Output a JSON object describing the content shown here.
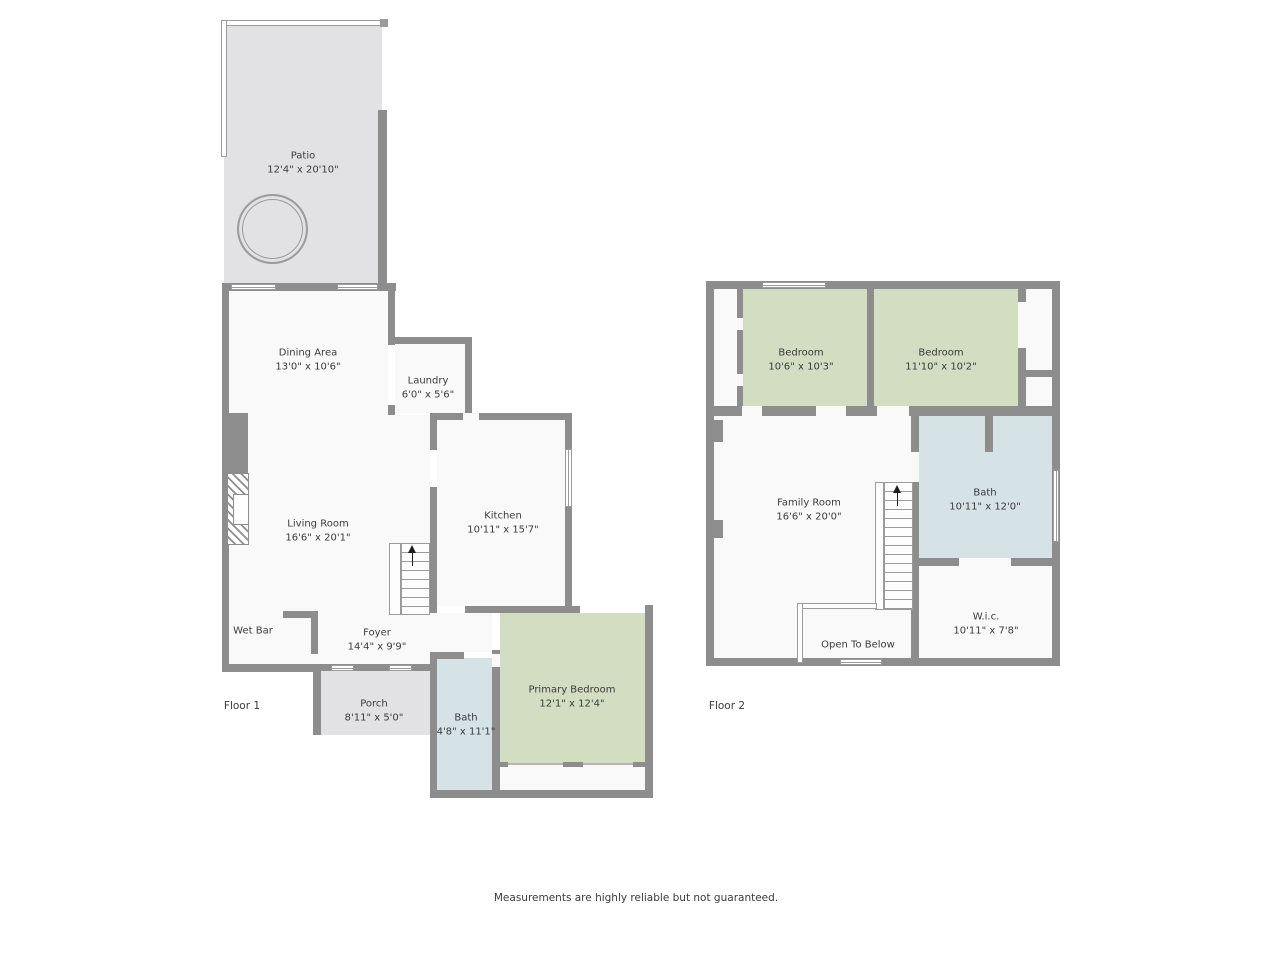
{
  "floor1": {
    "label": "Floor 1",
    "rooms": {
      "patio": {
        "name": "Patio",
        "dims": "12'4\" x 20'10\""
      },
      "dining_area": {
        "name": "Dining Area",
        "dims": "13'0\" x 10'6\""
      },
      "laundry": {
        "name": "Laundry",
        "dims": "6'0\" x 5'6\""
      },
      "living_room": {
        "name": "Living Room",
        "dims": "16'6\" x 20'1\""
      },
      "kitchen": {
        "name": "Kitchen",
        "dims": "10'11\" x 15'7\""
      },
      "wet_bar": {
        "name": "Wet Bar",
        "dims": ""
      },
      "foyer": {
        "name": "Foyer",
        "dims": "14'4\" x 9'9\""
      },
      "porch": {
        "name": "Porch",
        "dims": "8'11\" x 5'0\""
      },
      "bath": {
        "name": "Bath",
        "dims": "4'8\" x 11'1\""
      },
      "primary_bedroom": {
        "name": "Primary Bedroom",
        "dims": "12'1\" x 12'4\""
      }
    }
  },
  "floor2": {
    "label": "Floor 2",
    "rooms": {
      "bedroom_left": {
        "name": "Bedroom",
        "dims": "10'6\" x 10'3\""
      },
      "bedroom_right": {
        "name": "Bedroom",
        "dims": "11'10\" x 10'2\""
      },
      "family_room": {
        "name": "Family Room",
        "dims": "16'6\" x 20'0\""
      },
      "bath": {
        "name": "Bath",
        "dims": "10'11\" x 12'0\""
      },
      "wic": {
        "name": "W.i.c.",
        "dims": "10'11\" x 7'8\""
      },
      "open_to_below": {
        "name": "Open To Below",
        "dims": ""
      }
    }
  },
  "footer": {
    "disclaimer": "Measurements are highly reliable but not guaranteed."
  },
  "colors": {
    "wall": "#8d8d8d",
    "room_fill": "#f9f9f9",
    "outdoor_fill": "#e2e2e4",
    "bedroom_fill": "#d2ddc2",
    "bath_fill": "#d6e3e6"
  }
}
